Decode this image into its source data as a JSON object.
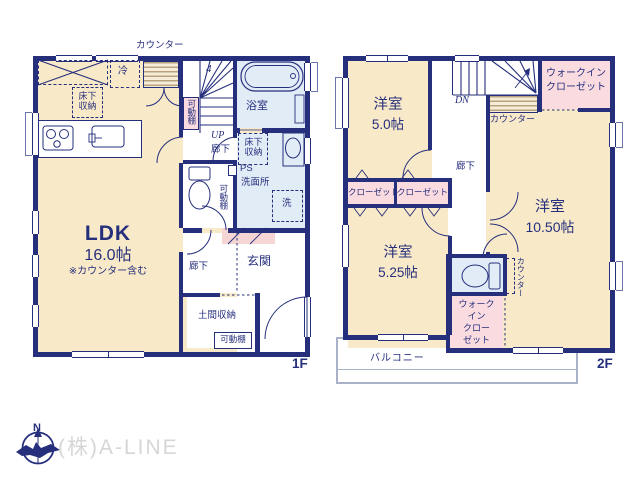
{
  "colors": {
    "wall": "#262f7c",
    "floor_cream": "#f8e9c9",
    "closet_pink": "#fadbe0",
    "wet_blue": "#e2ecf7",
    "step_pink": "#f6d5d5",
    "counter_stripe": "#b7a47e",
    "balcony_line": "#a9b2c9",
    "logo_gray": "#d6d6d6"
  },
  "floor1": {
    "floor_label": "1F",
    "ldk_name": "LDK",
    "ldk_size": "16.0帖",
    "ldk_note": "※カウンター含む",
    "counter_label": "カウンター",
    "fridge_label": "冷",
    "underfloor_kitchen": "床下収納",
    "underfloor_wash": "床下収納",
    "movable_shelf_stair": "可動棚",
    "movable_shelf_wash": "可動棚",
    "movable_shelf_doma": "可動棚",
    "stair_number": "4",
    "up_label": "UP",
    "hall_upper": "廊下",
    "hall_lower": "廊下",
    "bathroom": "浴室",
    "ps_label": "PS",
    "washroom": "洗面所",
    "washer_label": "洗",
    "entrance": "玄関",
    "doma_storage": "土間収納"
  },
  "floor2": {
    "floor_label": "2F",
    "room5_name": "洋室",
    "room5_size": "5.0帖",
    "room525_name": "洋室",
    "room525_size": "5.25帖",
    "room105_name": "洋室",
    "room105_size": "10.50帖",
    "dn_label": "DN",
    "wic_top_line1": "ウォークイン",
    "wic_top_line2": "クローゼット",
    "counter_stair": "カウンター",
    "hall": "廊下",
    "closet_left": "クローゼット",
    "closet_right": "クローゼット",
    "counter_desk": "カウンター",
    "wic_bottom_line1": "ウォーク",
    "wic_bottom_line2": "イン",
    "wic_bottom_line3": "クロー",
    "wic_bottom_line4": "ゼット",
    "balcony": "バルコニー"
  },
  "footer": {
    "company": "(株)A-LINE",
    "compass_north": "N"
  }
}
